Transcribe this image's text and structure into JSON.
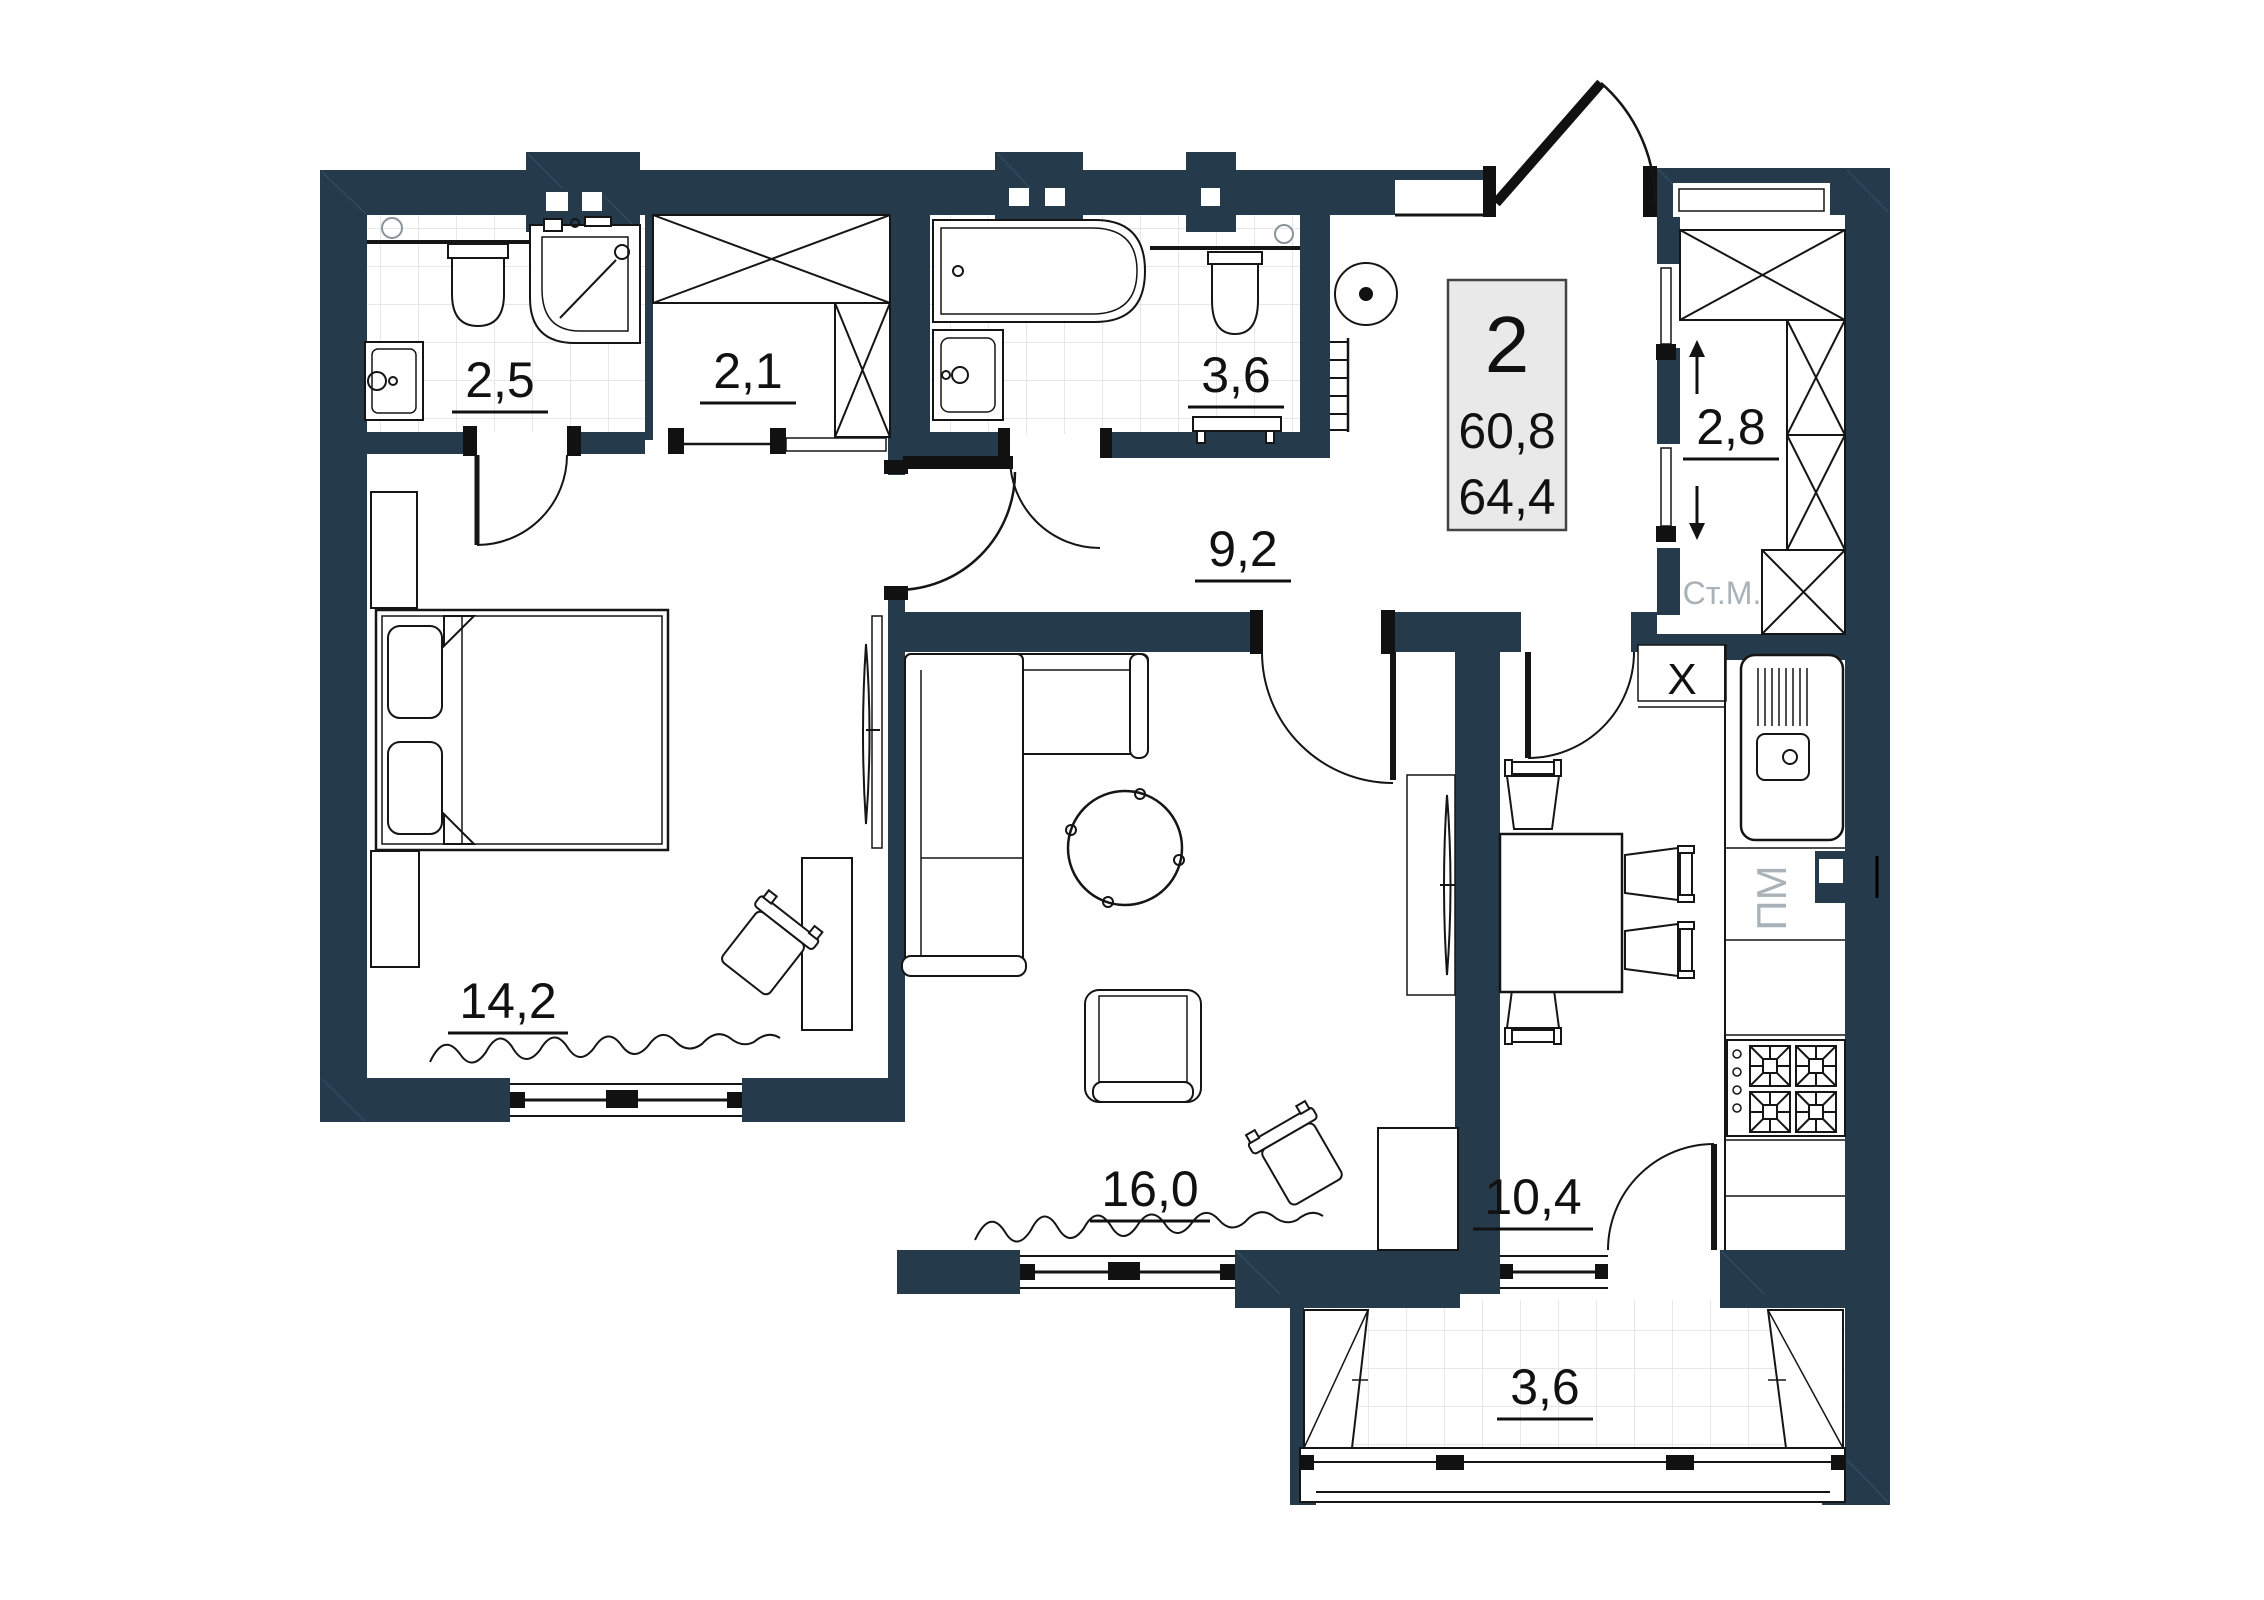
{
  "floor_plan": {
    "info_box": {
      "rooms_count": "2",
      "area_living": "60,8",
      "area_total": "64,4"
    },
    "room_labels": {
      "bath_small": "2,5",
      "wardrobe": "2,1",
      "bath_large": "3,6",
      "hallway": "9,2",
      "storage": "2,8",
      "bedroom": "14,2",
      "living_room": "16,0",
      "kitchen": "10,4",
      "balcony": "3,6"
    },
    "annotations": {
      "washing_machine": "Ст.М.",
      "dishwasher": "ПМ",
      "vent_shaft": "X",
      "arrow_up": "up-arrow",
      "arrow_down": "down-arrow"
    },
    "colors": {
      "wall": "#253B4C",
      "line": "#151515",
      "tile_line": "#e4e8eb",
      "muted_text": "#a9b2b8",
      "info_box_bg": "#e9e9e9"
    }
  }
}
